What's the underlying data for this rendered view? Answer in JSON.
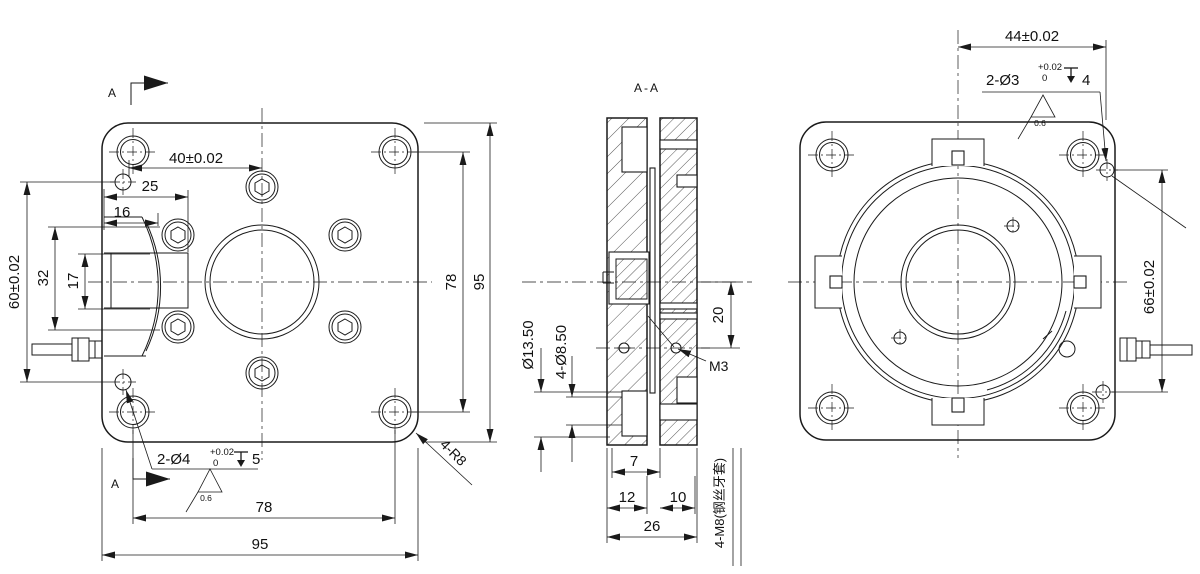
{
  "drawing": {
    "front_view": {
      "section_label_top": "A",
      "section_label_bottom": "A",
      "dim_40": "40±0.02",
      "dim_25": "25",
      "dim_16": "16",
      "dim_32": "32",
      "dim_17": "17",
      "dim_60": "60±0.02",
      "dim_78_right": "78",
      "dim_95_right": "95",
      "dim_78_bottom": "78",
      "dim_95_bottom": "95",
      "corner_radius_label": "4-R8",
      "hole_callout": {
        "text": "2-Ø4",
        "tol_upper": "+0.02",
        "tol_lower": "0",
        "depth": "5",
        "roughness": "0.6"
      }
    },
    "section_view": {
      "title": "A-A",
      "dim_bore": "Ø13.50",
      "dim_holes": "4-Ø8.50",
      "dim_20": "20",
      "thread_label": "M3",
      "dim_7": "7",
      "dim_12": "12",
      "dim_10": "10",
      "dim_26": "26",
      "insert_label": "4-M8(钢丝牙套)"
    },
    "side_view": {
      "dim_44": "44±0.02",
      "dim_66": "66±0.02",
      "hole_callout": {
        "text": "2-Ø3",
        "tol_upper": "+0.02",
        "tol_lower": "0",
        "depth": "4",
        "roughness": "0.6"
      }
    }
  }
}
